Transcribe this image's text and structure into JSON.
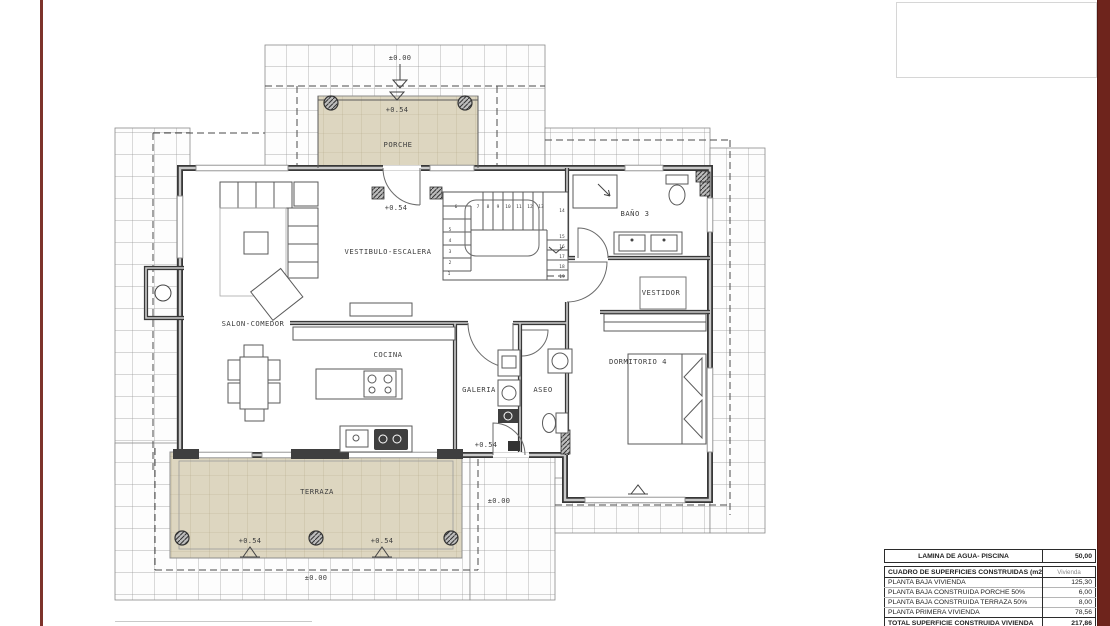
{
  "colors": {
    "border_red_left": "#7d332b",
    "border_red_right": "#6e241c",
    "tile_tan": "#ddd6c0",
    "wall_dark": "#383838"
  },
  "plan": {
    "rooms": [
      {
        "label": "PORCHE"
      },
      {
        "label": "VESTIBULO-ESCALERA"
      },
      {
        "label": "SALON-COMEDOR"
      },
      {
        "label": "COCINA"
      },
      {
        "label": "GALERIA"
      },
      {
        "label": "ASEO"
      },
      {
        "label": "BAÑO 3"
      },
      {
        "label": "VESTIDOR"
      },
      {
        "label": "DORMITORIO 4"
      },
      {
        "label": "TERRAZA"
      }
    ],
    "levels": [
      "±0.00",
      "+0.54",
      "+0.54",
      "+0.54",
      "±0.00",
      "+0.54",
      "+0.54",
      "±0.00"
    ],
    "stairs": {
      "numbers": [
        "1",
        "2",
        "3",
        "4",
        "5",
        "6",
        "7",
        "8",
        "9",
        "10",
        "11",
        "12",
        "13",
        "14",
        "15",
        "16",
        "17",
        "18",
        "19"
      ]
    }
  },
  "tables": {
    "pool": {
      "label": "LAMINA DE AGUA- PISCINA",
      "value": "50,00"
    },
    "surfaces": {
      "header": {
        "label": "CUADRO DE SUPERFICIES CONSTRUIDAS (m2)",
        "value": "Vivienda"
      },
      "rows": [
        {
          "label": "PLANTA BAJA VIVIENDA",
          "value": "125,30"
        },
        {
          "label": "PLANTA BAJA CONSTRUIDA PORCHE 50%",
          "value": "6,00"
        },
        {
          "label": "PLANTA BAJA CONSTRUIDA TERRAZA 50%",
          "value": "8,00"
        },
        {
          "label": "PLANTA PRIMERA VIVIENDA",
          "value": "78,56"
        }
      ],
      "total": {
        "label": "TOTAL SUPERFICIE CONSTRUIDA VIVIENDA",
        "value": "217,86"
      }
    }
  }
}
